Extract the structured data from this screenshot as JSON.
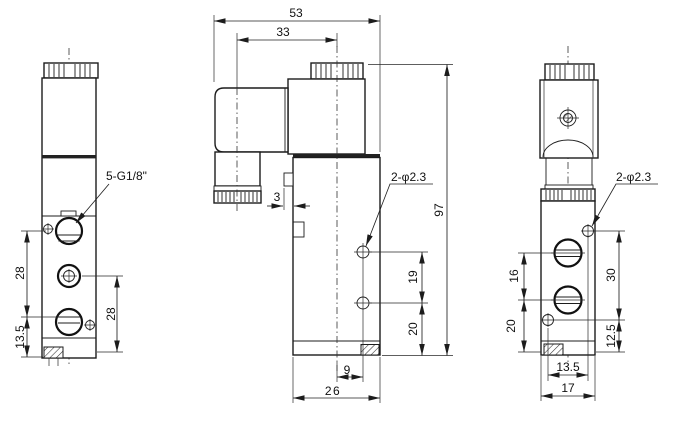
{
  "colors": {
    "background": "#ffffff",
    "line": "#1c1c1c"
  },
  "labels": {
    "front_thread": "5-G1/8\"",
    "front_port_spacing": "28",
    "front_bottom_offset": "13.5",
    "front_port_bottom": "28",
    "side_overall_width": "53",
    "side_gland_offset": "33",
    "side_step": "3",
    "side_holes": "2-φ2.3",
    "side_overall_height": "97",
    "side_hole_spacing": "19",
    "side_hole_bottom": "20",
    "side_hole_offset": "9",
    "side_body_width": "26",
    "end_holes": "2-φ2.3",
    "end_port_spacing": "16",
    "end_port_bottom": "20",
    "end_screw_spacing": "30",
    "end_screw_bottom": "12.5",
    "end_screw_width": "13.5",
    "end_body_width": "17"
  }
}
